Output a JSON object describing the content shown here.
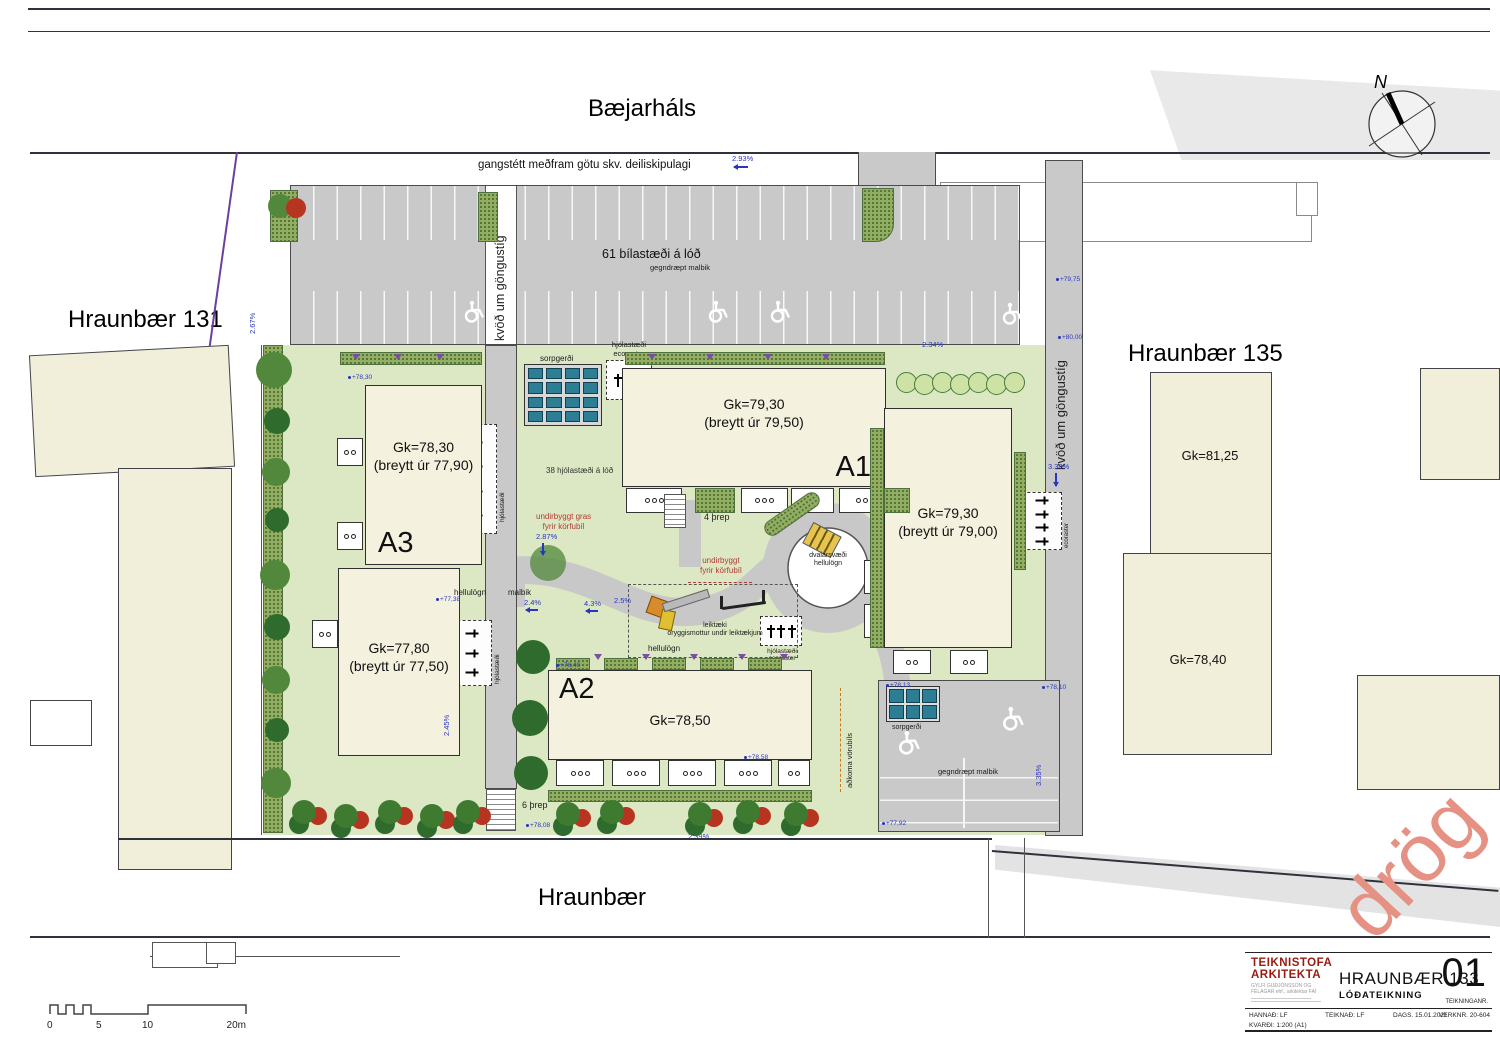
{
  "streets": {
    "top": "Bæjarháls",
    "bottom": "Hraunbær"
  },
  "neighbors": {
    "left": "Hraunbær 131",
    "right": "Hraunbær 135",
    "gk_81": "Gk=81,25",
    "gk_78": "Gk=78,40"
  },
  "buildings": {
    "a3": {
      "label": "A3",
      "gk": "Gk=78,30",
      "note": "(breytt úr 77,90)"
    },
    "b77": {
      "gk": "Gk=77,80",
      "note": "(breytt úr 77,50)"
    },
    "a1": {
      "label": "A1",
      "gk": "Gk=79,30",
      "note": "(breytt úr 79,50)"
    },
    "east": {
      "gk": "Gk=79,30",
      "note": "(breytt úr 79,00)"
    },
    "a2": {
      "label": "A2",
      "gk": "Gk=78,50"
    }
  },
  "notes": {
    "sidewalk": "gangstétt meðfram götu skv. deiliskipulagi",
    "parking": "61 bílastæði á lóð",
    "permeable": "gegndræpt malbik",
    "easement": "kvöð um göngustíg",
    "bikes38": "38 hjólastæði á lóð",
    "bike": "hjólastæði",
    "eco": "ecoraster",
    "waste": "sorpgerði",
    "paving": "hellulögn",
    "asphalt": "malbik",
    "steps4": "4 þrep",
    "steps6": "6 þrep",
    "play1": "leiktæki",
    "play2": "öryggismottur undir leiktækjum",
    "rest1": "dvalarsvæði",
    "rest2": "hellulögn",
    "grass1": "undirbyggt gras",
    "grass2": "fyrir körfubíl",
    "under1": "undirbyggt",
    "truck": "aðkoma vörubíls"
  },
  "percents": [
    "2.93%",
    "2.67%",
    "2.4%",
    "4.3%",
    "2.5%",
    "3.42%",
    "3.38%",
    "2.45%",
    "2.87%",
    "2.39%",
    "3.35%",
    "2.34%"
  ],
  "elevations": [
    "+78,30",
    "+77,38",
    "+77,92",
    "+78,10",
    "+78,13",
    "+78,40",
    "+78,58",
    "+79,75",
    "+80,00",
    "+78,08"
  ],
  "compass": {
    "label": "N"
  },
  "watermark": "drög",
  "scalebar": {
    "t0": "0",
    "t5": "5",
    "t10": "10",
    "t20": "20m"
  },
  "titleblock": {
    "firm1": "TEIKNISTOFA",
    "firm2": "ARKITEKTA",
    "firm_sub": "GYLFI GUÐJÓNSSON OG FÉLAGAR ehf., arkitektar FAÍ",
    "project": "HRAUNBÆR 133",
    "drawing": "LÓÐATEIKNING",
    "sheet": "01",
    "sheet_label": "TEIKNINGANR.",
    "designed": "HANNAÐ: LF",
    "drawn": "TEIKNAÐ: LF",
    "date": "DAGS. 15.01.2021",
    "job": "VERKNR. 20-604",
    "scale": "KVARÐI: 1:200 (A1)"
  }
}
